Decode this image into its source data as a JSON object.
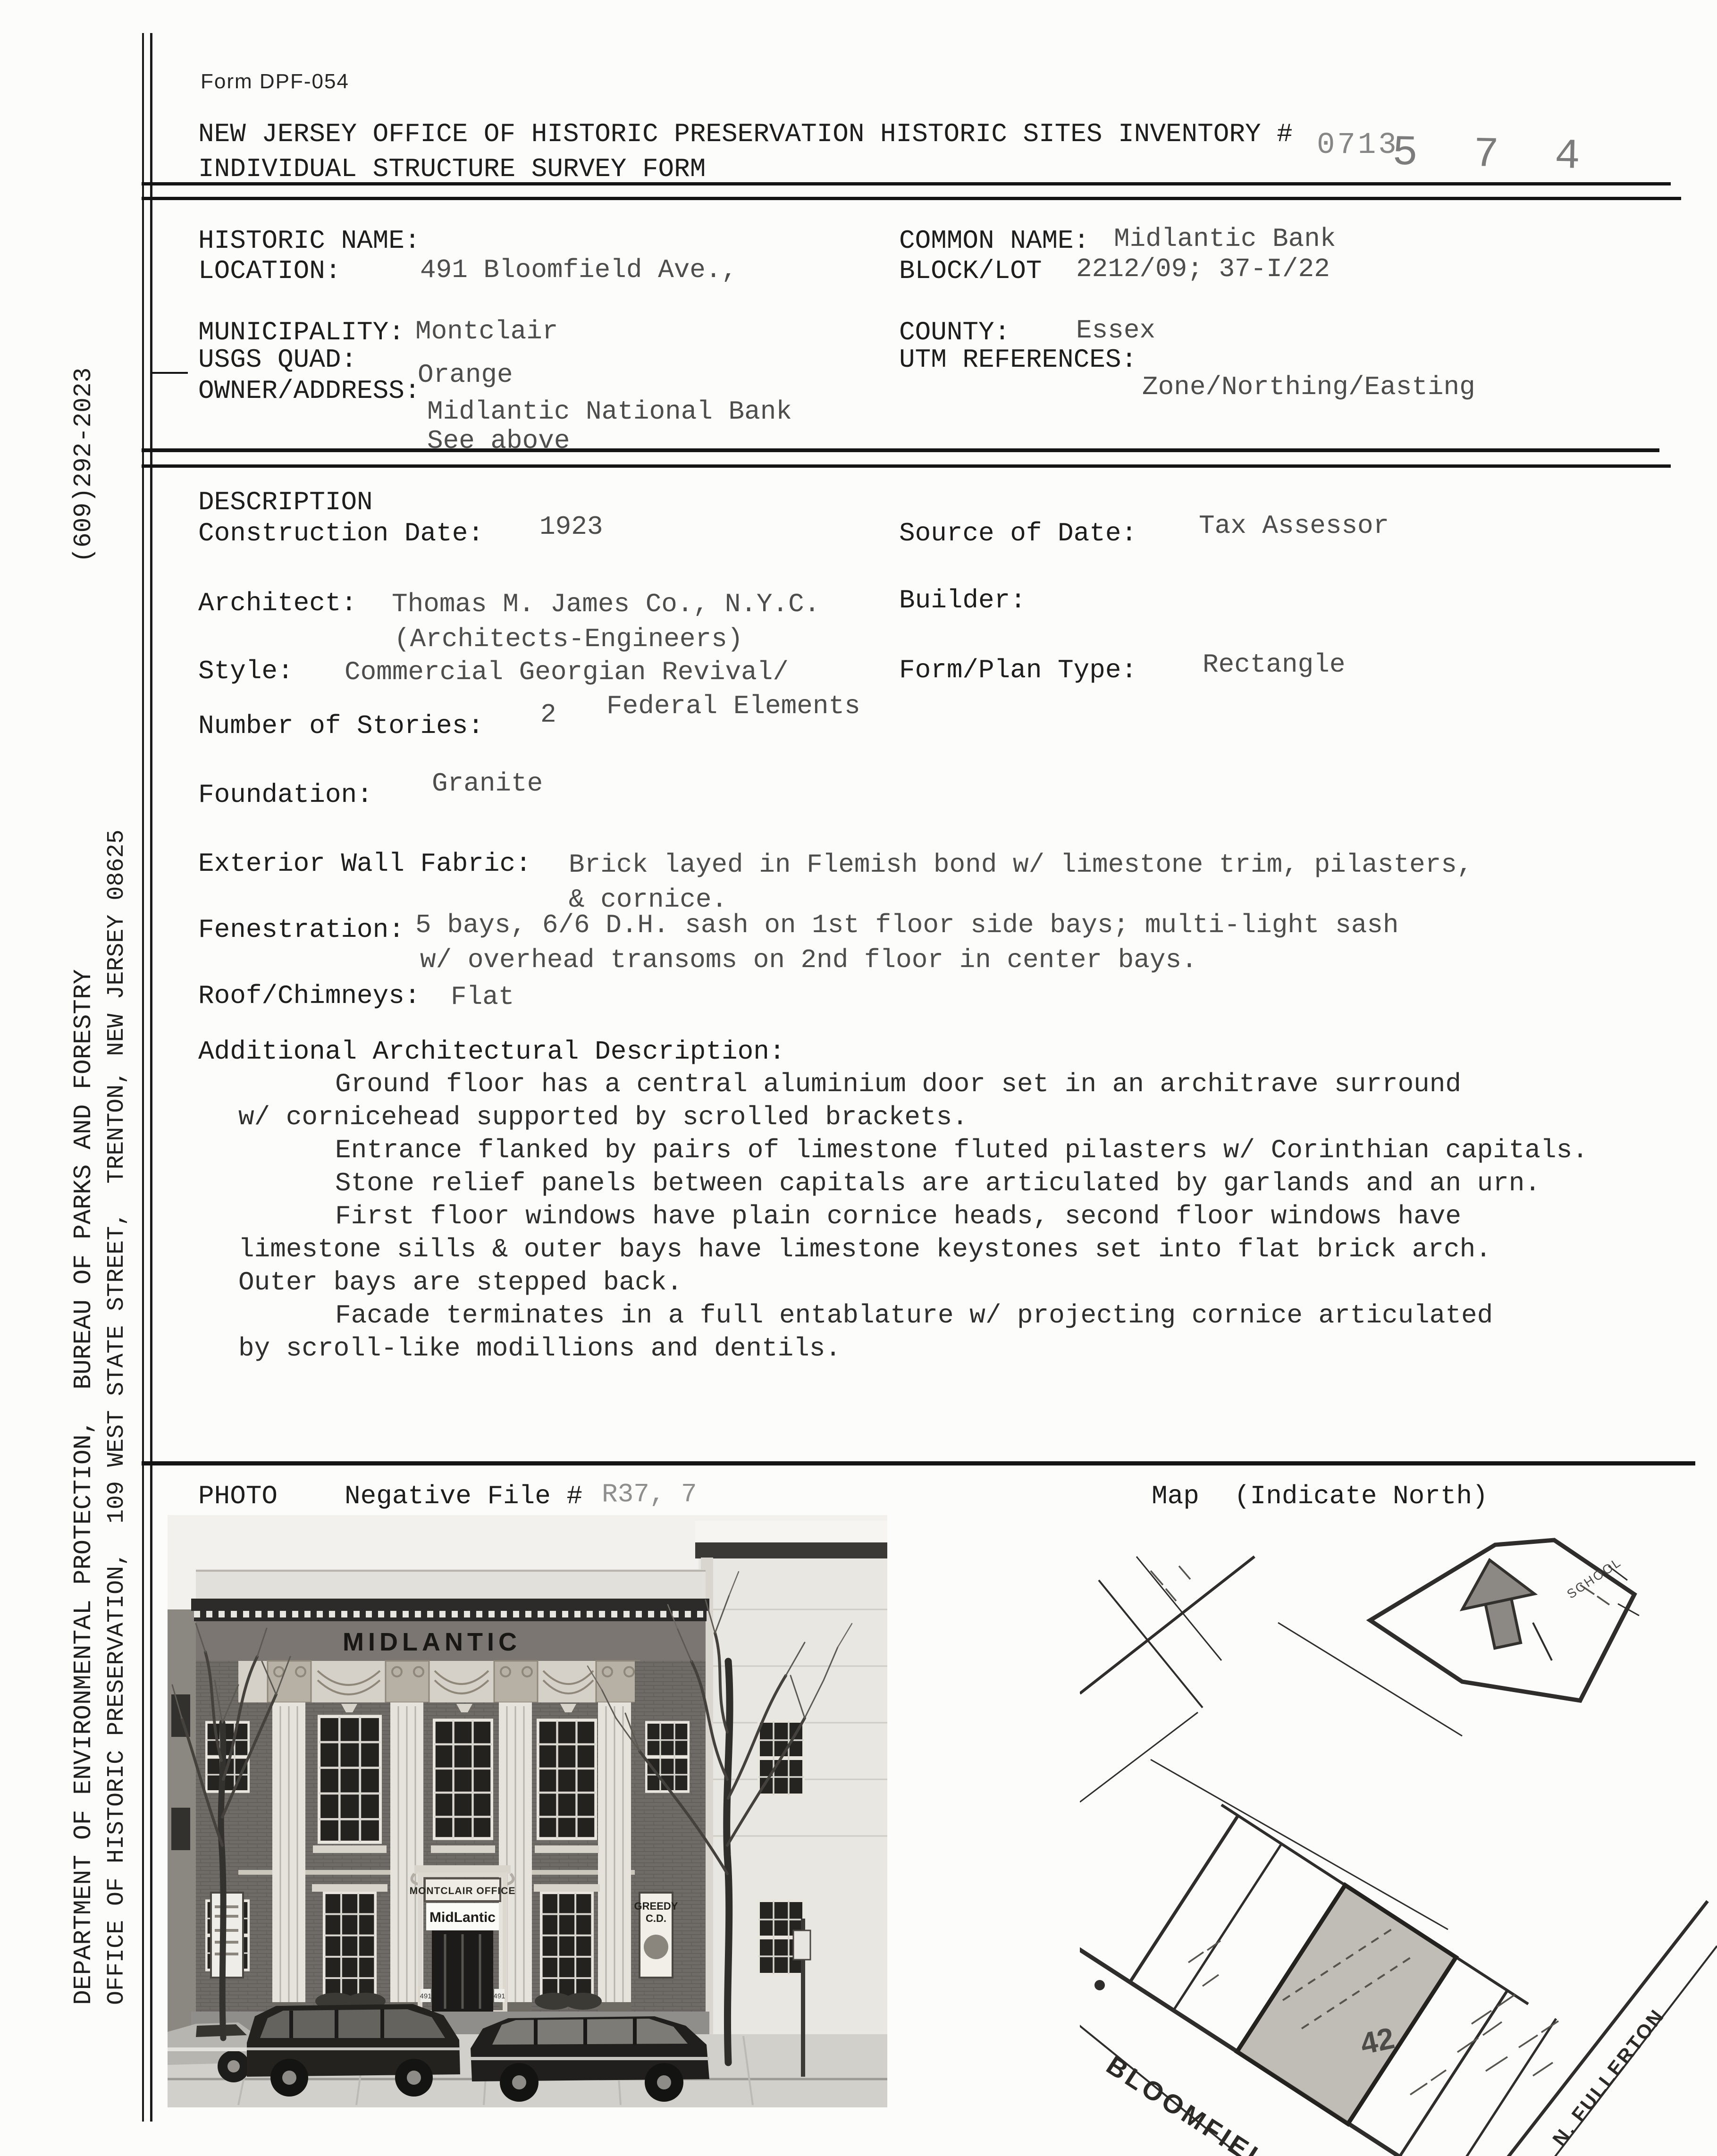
{
  "form": {
    "form_number": "Form DPF-054",
    "title_line1": "NEW JERSEY OFFICE OF HISTORIC PRESERVATION HISTORIC SITES INVENTORY #",
    "title_line2": "INDIVIDUAL STRUCTURE SURVEY FORM",
    "inventory_number_typed": "0713",
    "inventory_number_handwritten": "5 7 4"
  },
  "sidebar": {
    "department_line": "DEPARTMENT OF ENVIRONMENTAL PROTECTION,  BUREAU OF PARKS AND FORESTRY",
    "phone": "(609)292-2023",
    "office_line": "OFFICE OF HISTORIC PRESERVATION,  109 WEST STATE STREET,  TRENTON, NEW JERSEY 08625"
  },
  "identification": {
    "historic_name_label": "HISTORIC NAME:",
    "location_label": "LOCATION:",
    "location_value": "491 Bloomfield Ave.,",
    "common_name_label": "COMMON NAME:",
    "common_name_value": "Midlantic Bank",
    "block_lot_label": "BLOCK/LOT",
    "block_lot_value": "2212/09; 37-I/22",
    "municipality_label": "MUNICIPALITY:",
    "municipality_value": "Montclair",
    "county_label": "COUNTY:",
    "county_value": "Essex",
    "usgs_quad_label": "USGS QUAD:",
    "usgs_quad_value": "Orange",
    "utm_label": "UTM REFERENCES:",
    "utm_value": "Zone/Northing/Easting",
    "owner_label": "OWNER/ADDRESS:",
    "owner_value1": "Midlantic National Bank",
    "owner_value2": "See above"
  },
  "description": {
    "section_title": "DESCRIPTION",
    "construction_date_label": "Construction Date:",
    "construction_date_value": "1923",
    "source_label": "Source of Date:",
    "source_value": "Tax Assessor",
    "architect_label": "Architect:",
    "architect_value1": "Thomas M. James Co., N.Y.C.",
    "architect_value2": "(Architects-Engineers)",
    "builder_label": "Builder:",
    "style_label": "Style:",
    "style_value1": "Commercial Georgian Revival/",
    "style_value2": "Federal Elements",
    "form_plan_label": "Form/Plan Type:",
    "form_plan_value": "Rectangle",
    "stories_label": "Number of Stories:",
    "stories_value": "2",
    "foundation_label": "Foundation:",
    "foundation_value": "Granite",
    "wall_label": "Exterior Wall Fabric:",
    "wall_value1": "Brick layed in Flemish bond w/ limestone trim, pilasters,",
    "wall_value2": "& cornice.",
    "fenestration_label": "Fenestration:",
    "fenestration_value1": "5 bays, 6/6 D.H. sash on 1st floor side bays; multi-light sash",
    "fenestration_value2": "w/ overhead transoms on 2nd floor in center bays.",
    "roof_label": "Roof/Chimneys:",
    "roof_value": "Flat",
    "additional_label": "Additional Architectural Description:",
    "additional_lines": [
      "Ground floor has a central aluminium door set in an architrave surround",
      "w/ cornicehead supported by scrolled brackets.",
      "Entrance flanked by pairs of limestone fluted pilasters w/ Corinthian capitals.",
      "Stone relief panels between capitals are articulated by garlands and an urn.",
      "First floor windows have plain cornice heads, second floor windows have",
      "limestone sills & outer bays have limestone keystones set into flat brick arch.",
      "Outer bays are stepped back.",
      "Facade terminates in a full entablature w/ projecting cornice articulated",
      "by scroll-like modillions and dentils."
    ]
  },
  "photo_section": {
    "photo_label": "PHOTO",
    "negative_label": "Negative File #",
    "negative_value": "R37, 7",
    "map_label": "Map",
    "map_note": "(Indicate North)",
    "photo_signs": {
      "entablature": "MIDLANTIC",
      "office_sign": "MONTCLAIR OFFICE",
      "door_sign": "MidLantic",
      "poster_line1": "GREEDY",
      "poster_line2": "C.D.",
      "address": "491"
    }
  },
  "map": {
    "street1": "BLOOMFIELD AV.",
    "street2": "N. FULLERTON",
    "school": "SCHOOL",
    "parcel_number": "42"
  }
}
